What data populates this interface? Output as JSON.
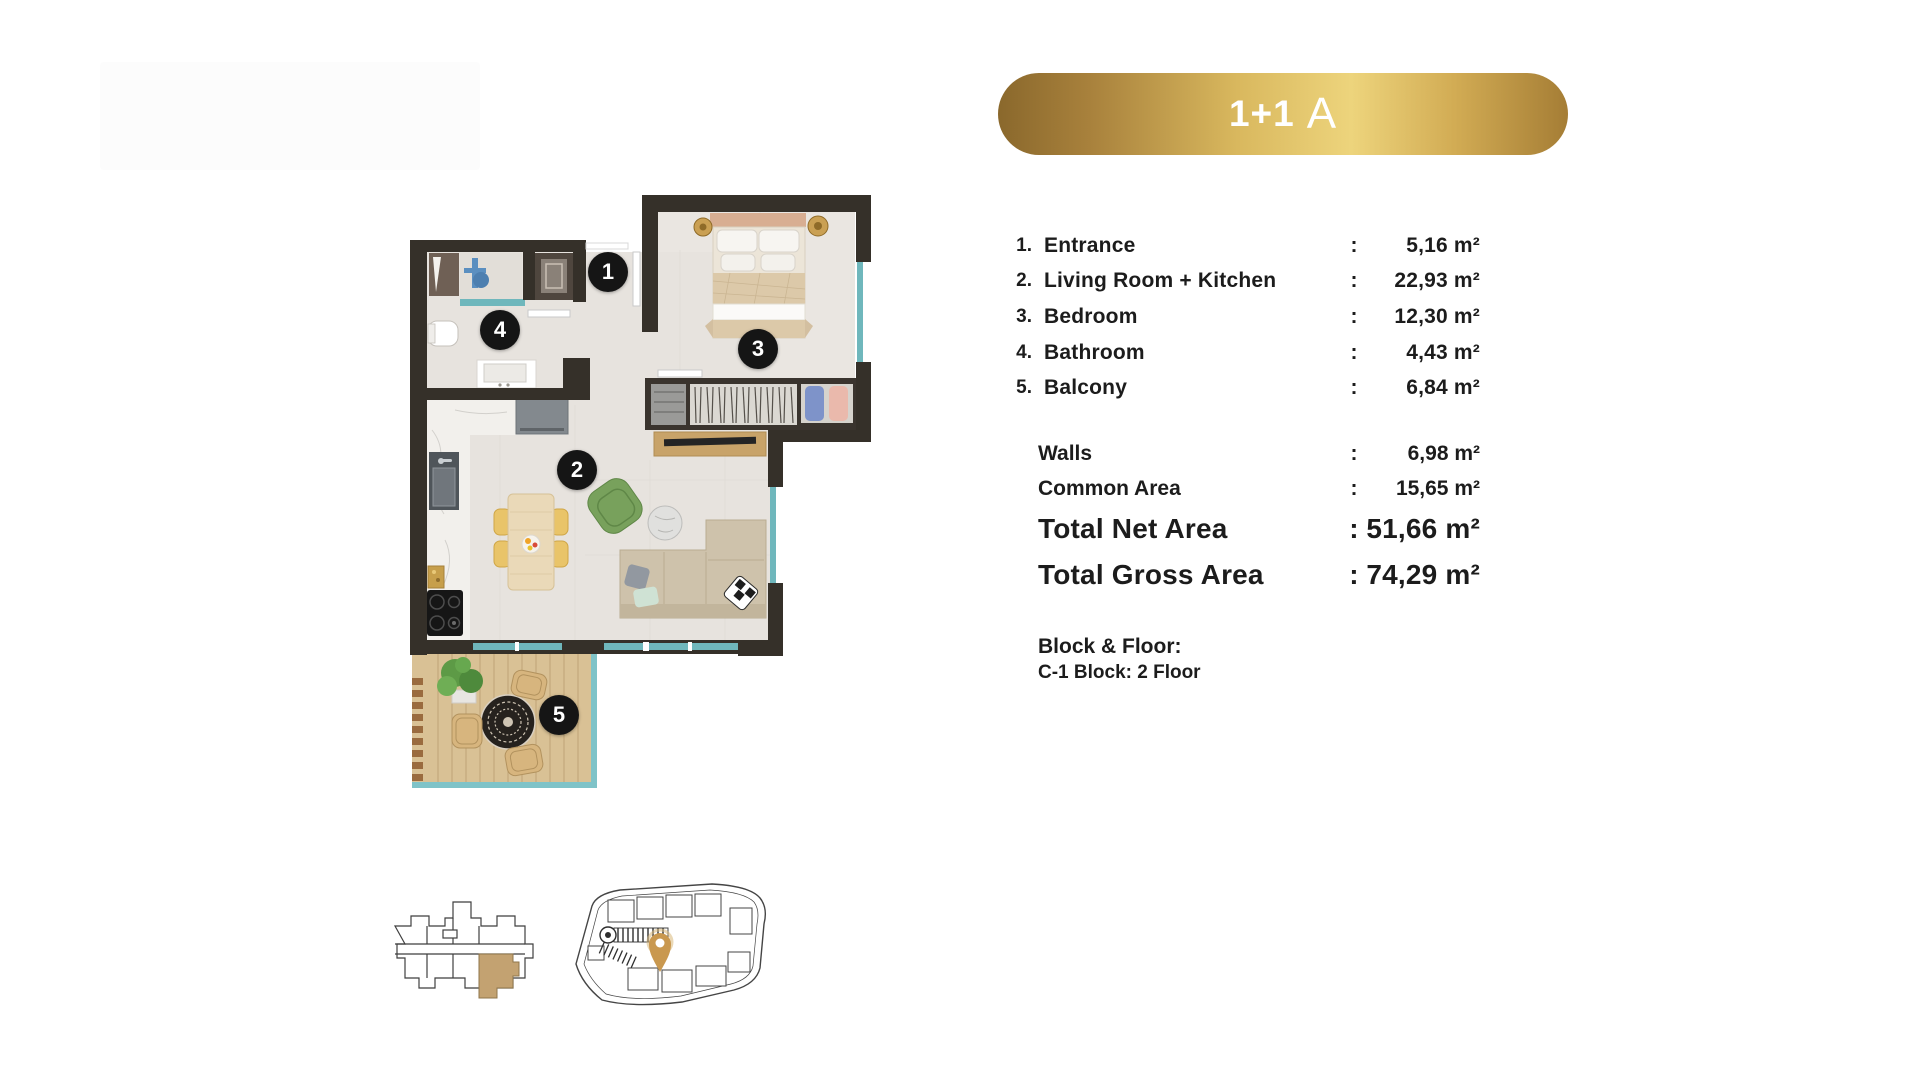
{
  "banner": {
    "unit_type_main": "1+1",
    "unit_type_variant": "A"
  },
  "area_table": {
    "colon": ":",
    "rooms": [
      {
        "num": "1.",
        "label": "Entrance",
        "value": "5,16 m²"
      },
      {
        "num": "2.",
        "label": "Living Room + Kitchen",
        "value": "22,93 m²"
      },
      {
        "num": "3.",
        "label": "Bedroom",
        "value": "12,30 m²"
      },
      {
        "num": "4.",
        "label": "Bathroom",
        "value": "4,43 m²"
      },
      {
        "num": "5.",
        "label": "Balcony",
        "value": "6,84 m²"
      }
    ],
    "summary": [
      {
        "label": "Walls",
        "value": "6,98 m²"
      },
      {
        "label": "Common Area",
        "value": "15,65 m²"
      },
      {
        "label": "Total Net Area",
        "value": "51,66 m²"
      },
      {
        "label": "Total Gross Area",
        "value": "74,29 m²"
      }
    ],
    "block_floor_title": "Block & Floor:",
    "block_floor_value": "C-1 Block: 2 Floor"
  },
  "floorplan": {
    "markers": [
      {
        "n": "1"
      },
      {
        "n": "2"
      },
      {
        "n": "3"
      },
      {
        "n": "4"
      },
      {
        "n": "5"
      }
    ],
    "colors": {
      "wall": "#353029",
      "floor": "#e7e3de",
      "marble": "#f2f0ec",
      "balcony_wood": "#d9c195",
      "window_glass": "#6fb7bc",
      "accent_gold": "#c9984f",
      "highlight_unit": "#c3a271"
    }
  }
}
